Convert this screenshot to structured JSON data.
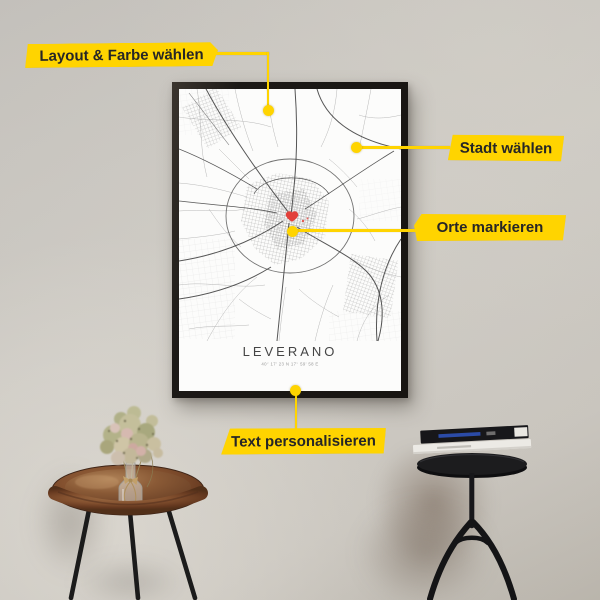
{
  "scene": {
    "wall_color": "#c9c6c0",
    "accent_color": "#FFD400"
  },
  "poster": {
    "title": "LEVERANO",
    "coordinates": "40° 17' 23 N 17° 59' 58 E",
    "frame_color": "#1c1916",
    "paper_color": "#fcfcfb",
    "marker_color": "#e2413b"
  },
  "callouts": {
    "items": [
      {
        "label": "Layout & Farbe wählen"
      },
      {
        "label": "Stadt wählen"
      },
      {
        "label": "Orte markieren"
      },
      {
        "label": "Text personalisieren"
      }
    ]
  }
}
